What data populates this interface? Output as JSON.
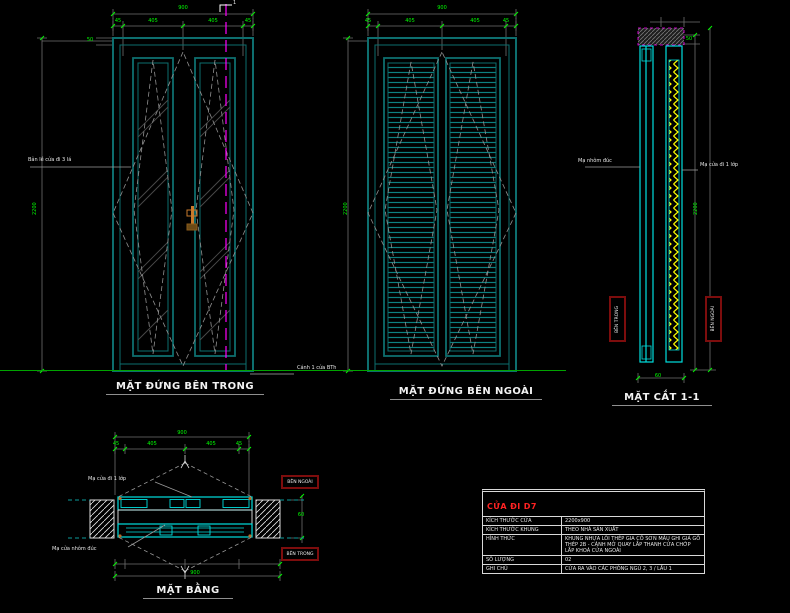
{
  "colors": {
    "frame_teal": "#0d6e6e",
    "profile_cyan": "#00dede",
    "dim_green": "#00ff00",
    "centerline_magenta": "#ff00ff",
    "zigzag_yellow": "#ffff00",
    "ground_green": "#00a400",
    "table_red": "#ff2222"
  },
  "views": {
    "elevation_inside": {
      "title": "MẶT ĐỨNG BÊN TRONG",
      "section_mark": "1",
      "note_hinge": "Bản lề cửa đi 3 lá",
      "note_base": "Cánh 1 cửa BTh",
      "dims": {
        "total_width": "900",
        "head": "50",
        "left": "45",
        "leaf1": "405",
        "leaf2": "405",
        "right": "45",
        "height": "2200"
      }
    },
    "elevation_outside": {
      "title": "MẶT ĐỨNG BÊN NGOÀI",
      "dims": {
        "total_width": "900",
        "left": "45",
        "leaf1": "405",
        "leaf2": "405",
        "right": "45",
        "height": "2200"
      }
    },
    "section": {
      "title": "MẶT CẮT 1-1",
      "note_left": "Mạ nhôm đúc",
      "note_right": "Mạ cửa đi 1 lớp",
      "label_inside": "BÊN TRONG",
      "label_outside": "BÊN NGOÀI",
      "dims": {
        "head": "50",
        "height": "2200",
        "thickness": "60"
      }
    },
    "plan": {
      "title": "MẶT BẰNG",
      "note_top": "Mạ cửa đi 1 lớp",
      "note_bottom": "Mạ cửa nhôm đúc",
      "label_outside": "BÊN NGOÀI",
      "label_inside": "BÊN TRONG",
      "dims": {
        "total_width": "900",
        "left": "45",
        "leaf1": "405",
        "leaf2": "405",
        "right": "45",
        "thickness": "60",
        "total_bottom": "900"
      }
    }
  },
  "table": {
    "title": "CỬA ĐI D7",
    "rows": [
      {
        "label": "KÍCH THƯỚC CỬA",
        "value": "2200x900"
      },
      {
        "label": "KÍCH THƯỚC KHUNG",
        "value": "THEO NHÀ SẢN XUẤT"
      },
      {
        "label": "HÌNH THỨC",
        "value": "KHUNG NHỰA LÕI THÉP GIA CỐ SƠN MÀU GHI GIẢ GỖ THÉP 2B - CÁNH MỞ QUAY LẮP THANH CỬA CHỚP LẮP KHOÁ CỬA NGOÀI"
      },
      {
        "label": "SỐ LƯỢNG",
        "value": "02"
      },
      {
        "label": "GHI CHÚ",
        "value": "CỬA RA VÀO CÁC PHÒNG NGỦ 2, 3 / LẦU 1"
      }
    ]
  }
}
